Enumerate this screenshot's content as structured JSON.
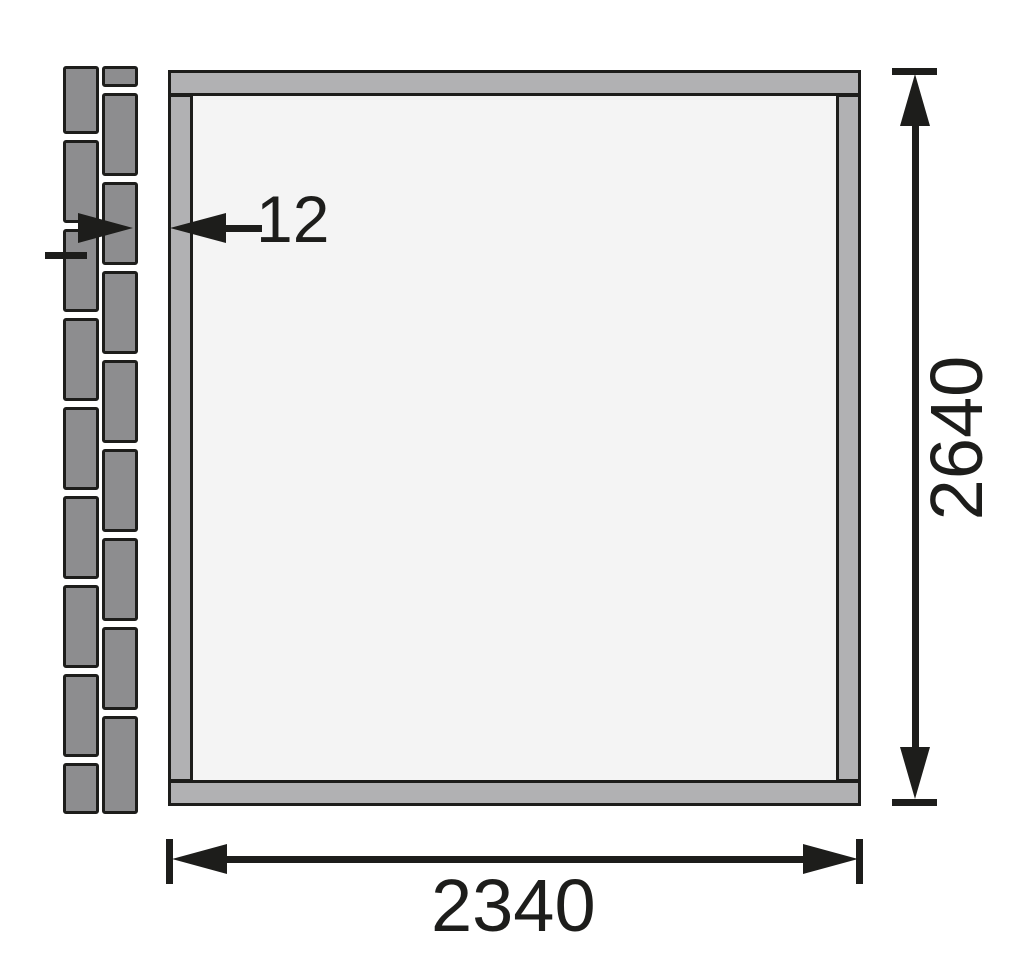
{
  "drawing": {
    "type": "technical-dimension-drawing",
    "views": [
      "wall-cross-section",
      "wall-panel-front"
    ],
    "dimensions": {
      "width": {
        "label": "2340"
      },
      "height": {
        "label": "2640"
      },
      "thickness": {
        "label": "12"
      }
    }
  },
  "colors": {
    "background": "#ffffff",
    "line": "#1d1d1b",
    "frame_fill": "#b1b1b3",
    "panel_fill": "#f4f4f4",
    "plank_fill": "#8d8d8f"
  },
  "cross_section": {
    "columns": [
      {
        "x": 63,
        "width": 36,
        "planks": [
          {
            "y": 66,
            "h": 68
          },
          {
            "y": 140,
            "h": 83
          },
          {
            "y": 229,
            "h": 83
          },
          {
            "y": 318,
            "h": 83
          },
          {
            "y": 407,
            "h": 83
          },
          {
            "y": 496,
            "h": 83
          },
          {
            "y": 585,
            "h": 83
          },
          {
            "y": 674,
            "h": 83
          },
          {
            "y": 763,
            "h": 51
          }
        ]
      },
      {
        "x": 102,
        "width": 36,
        "planks": [
          {
            "y": 66,
            "h": 21
          },
          {
            "y": 93,
            "h": 83
          },
          {
            "y": 182,
            "h": 83
          },
          {
            "y": 271,
            "h": 83
          },
          {
            "y": 360,
            "h": 83
          },
          {
            "y": 449,
            "h": 83
          },
          {
            "y": 538,
            "h": 83
          },
          {
            "y": 627,
            "h": 83
          },
          {
            "y": 716,
            "h": 98
          }
        ]
      }
    ]
  }
}
